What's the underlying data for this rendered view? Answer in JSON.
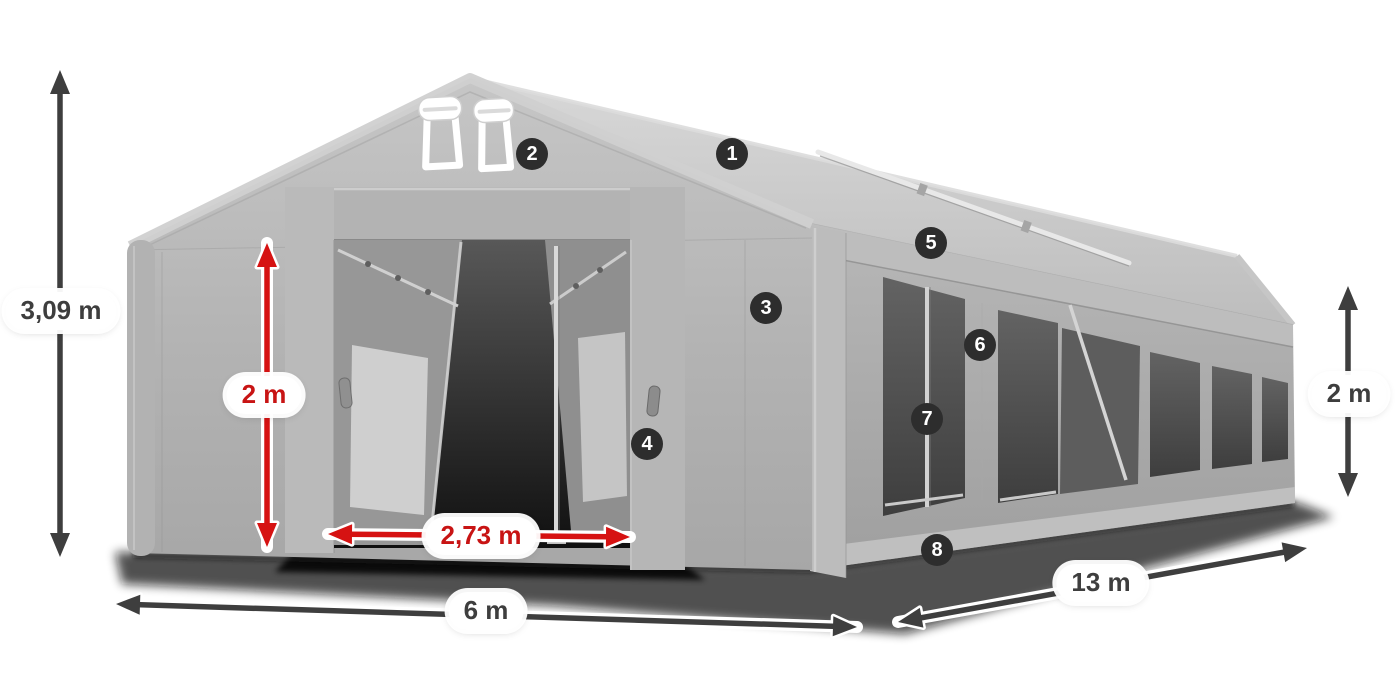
{
  "diagram": {
    "background_color": "#ffffff",
    "badge_color": "#2d2d2d",
    "badge_text_color": "#ffffff",
    "dark_color": "#3e3e3e",
    "red_color": "#d61212",
    "badges": [
      {
        "number": "1",
        "x": 732,
        "y": 154
      },
      {
        "number": "2",
        "x": 532,
        "y": 154
      },
      {
        "number": "3",
        "x": 766,
        "y": 308
      },
      {
        "number": "4",
        "x": 647,
        "y": 444
      },
      {
        "number": "5",
        "x": 931,
        "y": 243
      },
      {
        "number": "6",
        "x": 980,
        "y": 345
      },
      {
        "number": "7",
        "x": 927,
        "y": 419
      },
      {
        "number": "8",
        "x": 937,
        "y": 550
      }
    ],
    "dimensions": [
      {
        "id": "total-height",
        "label": "3,09 m",
        "style": "dark",
        "pill": {
          "x": 61,
          "y": 311
        },
        "arrow": {
          "x1": 60,
          "y1": 70,
          "x2": 60,
          "y2": 557
        }
      },
      {
        "id": "entrance-height",
        "label": "2 m",
        "style": "red",
        "pill": {
          "x": 264,
          "y": 395
        },
        "arrow": {
          "x1": 267,
          "y1": 243,
          "x2": 267,
          "y2": 547
        }
      },
      {
        "id": "entrance-width",
        "label": "2,73 m",
        "style": "red",
        "pill": {
          "x": 481,
          "y": 536
        },
        "arrow": {
          "x1": 328,
          "y1": 534,
          "x2": 630,
          "y2": 537
        }
      },
      {
        "id": "width",
        "label": "6 m",
        "style": "dark",
        "pill": {
          "x": 486,
          "y": 611
        },
        "arrow": {
          "x1": 116,
          "y1": 604,
          "x2": 857,
          "y2": 627
        }
      },
      {
        "id": "length",
        "label": "13 m",
        "style": "dark",
        "pill": {
          "x": 1101,
          "y": 583
        },
        "arrow": {
          "x1": 898,
          "y1": 622,
          "x2": 1307,
          "y2": 548
        }
      },
      {
        "id": "side-height",
        "label": "2 m",
        "style": "dark",
        "pill": {
          "x": 1349,
          "y": 394
        },
        "arrow": {
          "x1": 1348,
          "y1": 286,
          "x2": 1348,
          "y2": 497
        }
      }
    ]
  }
}
